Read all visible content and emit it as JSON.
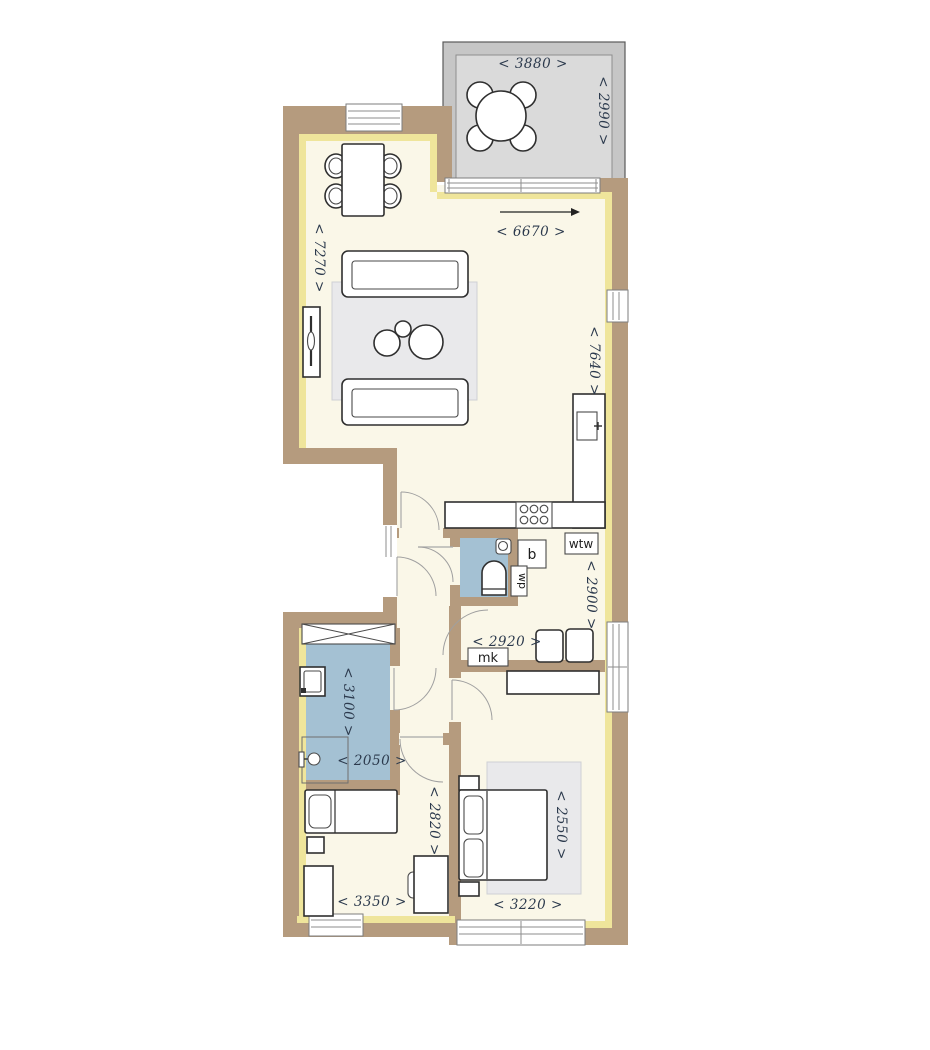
{
  "plan": {
    "dimensions": {
      "balcony_width": "< 3880 >",
      "balcony_depth": "< 2990 >",
      "living_width": "< 6670 >",
      "living_length": "< 7270 >",
      "kitchen_wall_length": "< 7640 >",
      "tech_room_depth": "< 2900 >",
      "hall_width": "< 2920 >",
      "bathroom_length": "< 3100 >",
      "bathroom_width": "< 2050 >",
      "bedroom2_width": "< 3350 >",
      "bedroom2_depth": "< 2820 >",
      "master_width": "< 3220 >",
      "master_depth": "< 2550 >"
    },
    "labels": {
      "boiler": "b",
      "heat_pump": "wp",
      "heat_recovery_unit": "wtw",
      "meter_cupboard": "mk"
    },
    "colors": {
      "wall": "#b59b7e",
      "insulation": "#efe59b",
      "floor": "#faf7e8",
      "wet_room": "#a4c1d3",
      "balcony_wall": "#c6c6c6",
      "balcony_floor": "#dadada",
      "rug": "#e9e9eb",
      "dimension_text": "#2c3a4d"
    }
  }
}
